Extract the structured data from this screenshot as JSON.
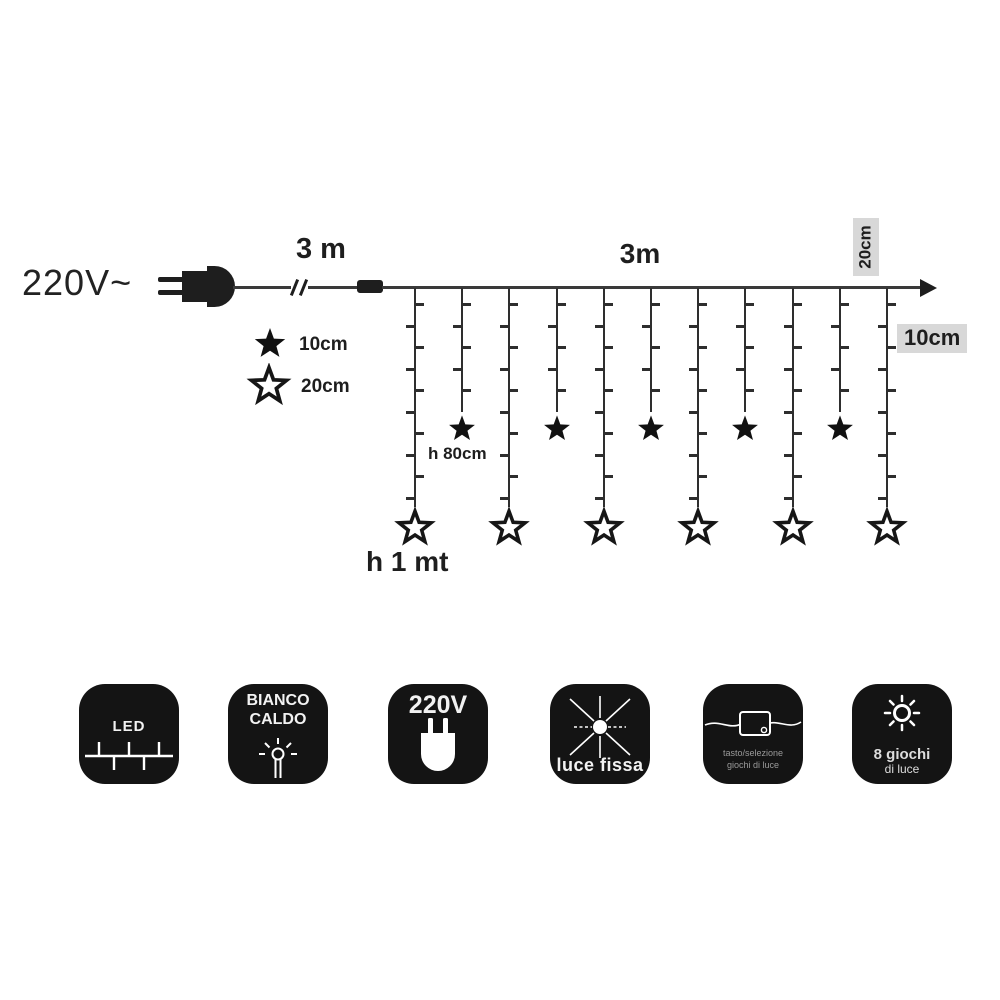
{
  "diagram": {
    "voltage": "220V~",
    "lead_length": "3 m",
    "main_length": "3m",
    "end_spacing": "20cm",
    "led_spacing": "10cm",
    "legend": {
      "filled_star": "10cm",
      "outline_star": "20cm"
    },
    "short_drop_height": "h 80cm",
    "long_drop_height": "h 1 mt",
    "drops": {
      "count": 11,
      "long_drop_star": "outline 20cm star",
      "short_drop_star": "filled 10cm star"
    }
  },
  "features": {
    "led": {
      "label": "LED"
    },
    "color": {
      "line1": "BIANCO",
      "line2": "CALDO"
    },
    "voltage": {
      "label": "220V"
    },
    "steady": {
      "label": "luce fissa"
    },
    "controller": {
      "line1": "tasto/selezione",
      "line2": "giochi di luce"
    },
    "modes": {
      "line1": "8 giochi",
      "line2": "di luce"
    }
  },
  "colors": {
    "ink": "#1e1e1e",
    "wire": "#3a3a3a",
    "badge_bg": "#141414",
    "label_bg": "#d8d8d8",
    "muted_text": "#9a9a9a"
  }
}
